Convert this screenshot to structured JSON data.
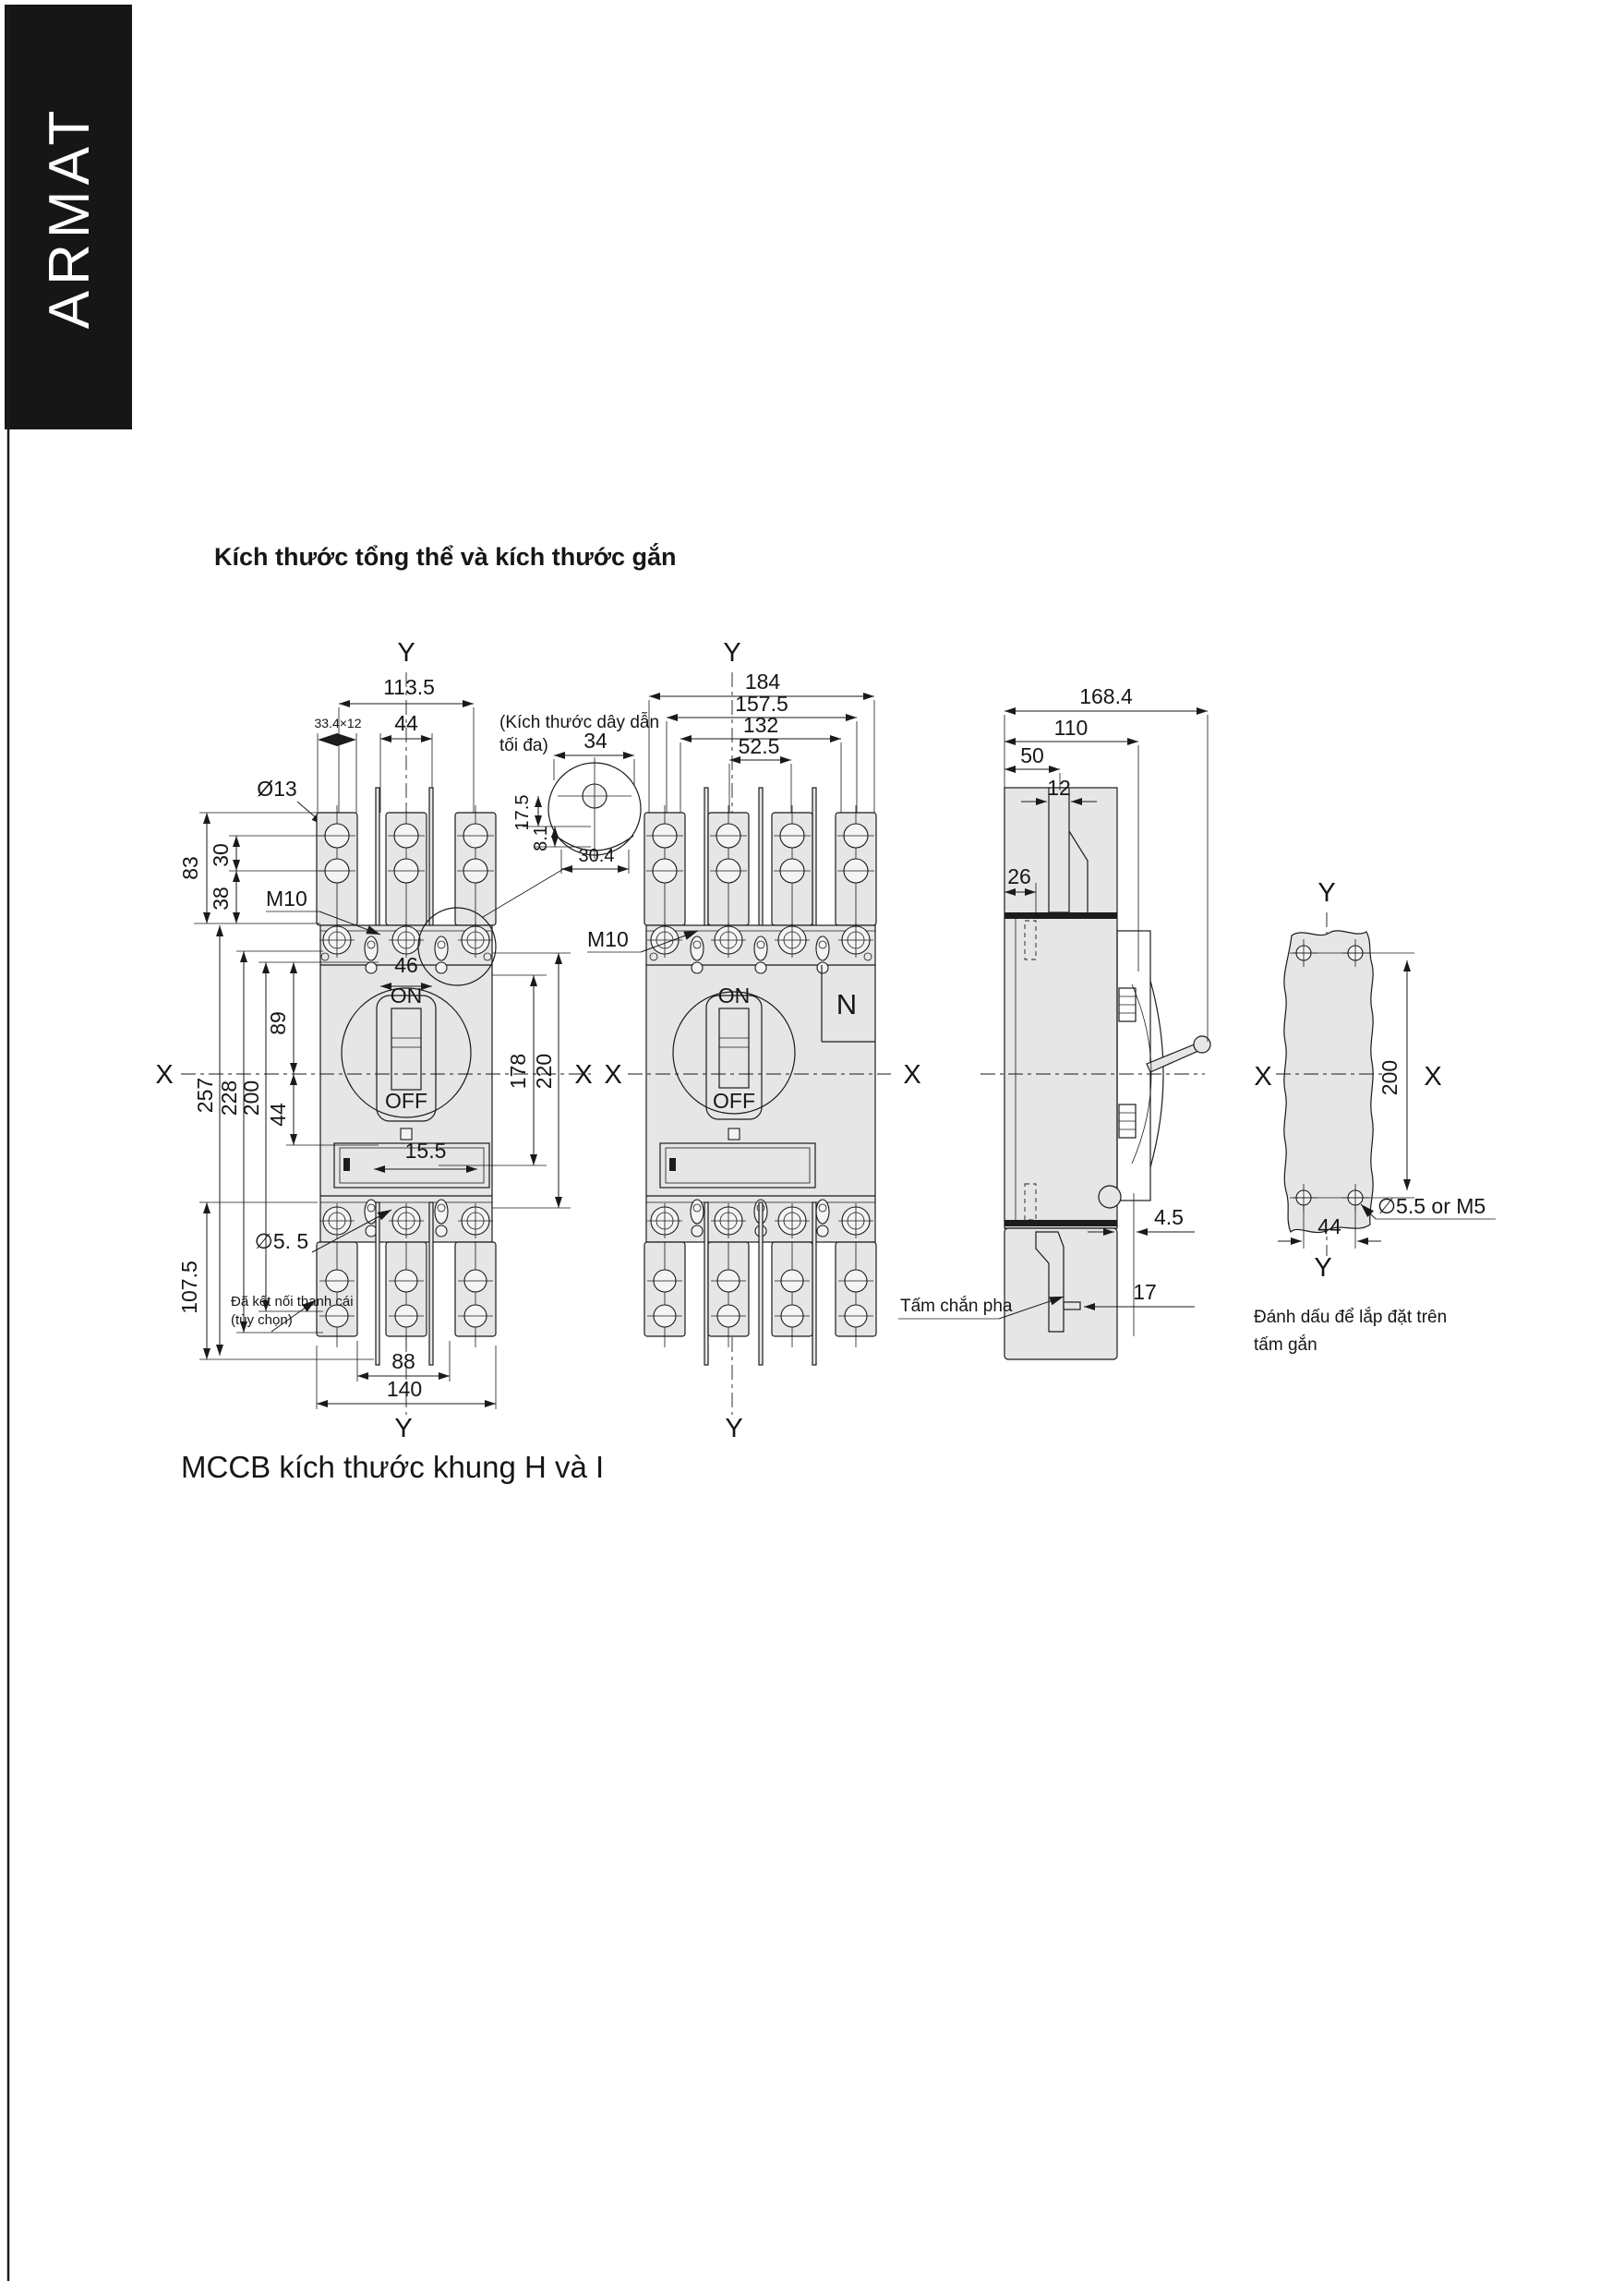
{
  "brand": {
    "name": "ARMAT"
  },
  "page": {
    "title": "Kích thước tổng thể và kích thước gắn",
    "caption": "MCCB kích thước khung H và I"
  },
  "colors": {
    "line": "#1a1a1a",
    "fill": "#e6e6e6",
    "banner_bg": "#161616",
    "banner_text": "#ffffff"
  },
  "axes": {
    "x": "X",
    "y": "Y"
  },
  "v1": {
    "dims": {
      "w113_5": "113.5",
      "w44": "44",
      "slot": "33.4×12",
      "hole_top": "Ø13",
      "h83": "83",
      "h30": "30",
      "h38": "38",
      "screw": "M10",
      "w46": "46",
      "h257": "257",
      "h228": "228",
      "h200": "200",
      "h89": "89",
      "h44": "44",
      "h178": "178",
      "h220": "220",
      "w15_5": "15.5",
      "hole_bottom": "∅5. 5",
      "h107_5": "107.5",
      "w88": "88",
      "w140": "140"
    },
    "switch": {
      "on": "ON",
      "off": "OFF"
    },
    "notes": {
      "busbar1": "Đã kết nối thanh cái",
      "busbar2": "(tùy chọn)"
    }
  },
  "inset": {
    "note1": "(Kích thước dây dẫn",
    "note2": "tối đa)",
    "dims": {
      "w34": "34",
      "h17_5": "17.5",
      "h8_1": "8.1",
      "w30_4": "30.4"
    }
  },
  "v2": {
    "dims": {
      "w184": "184",
      "w157_5": "157.5",
      "w132": "132",
      "w52_5": "52.5",
      "screw": "M10"
    },
    "labels": {
      "neutral": "N"
    },
    "switch": {
      "on": "ON",
      "off": "OFF"
    }
  },
  "v3": {
    "dims": {
      "d168_4": "168.4",
      "d110": "110",
      "d50": "50",
      "d12": "12",
      "d26": "26",
      "d4_5": "4.5",
      "d17": "17"
    },
    "notes": {
      "barrier": "Tấm chắn pha"
    }
  },
  "v4": {
    "dims": {
      "h200": "200",
      "w44": "44",
      "hole": "∅5.5 or M5"
    },
    "notes": {
      "line1": "Đánh dấu để lắp đặt trên",
      "line2": "tấm gắn"
    }
  }
}
